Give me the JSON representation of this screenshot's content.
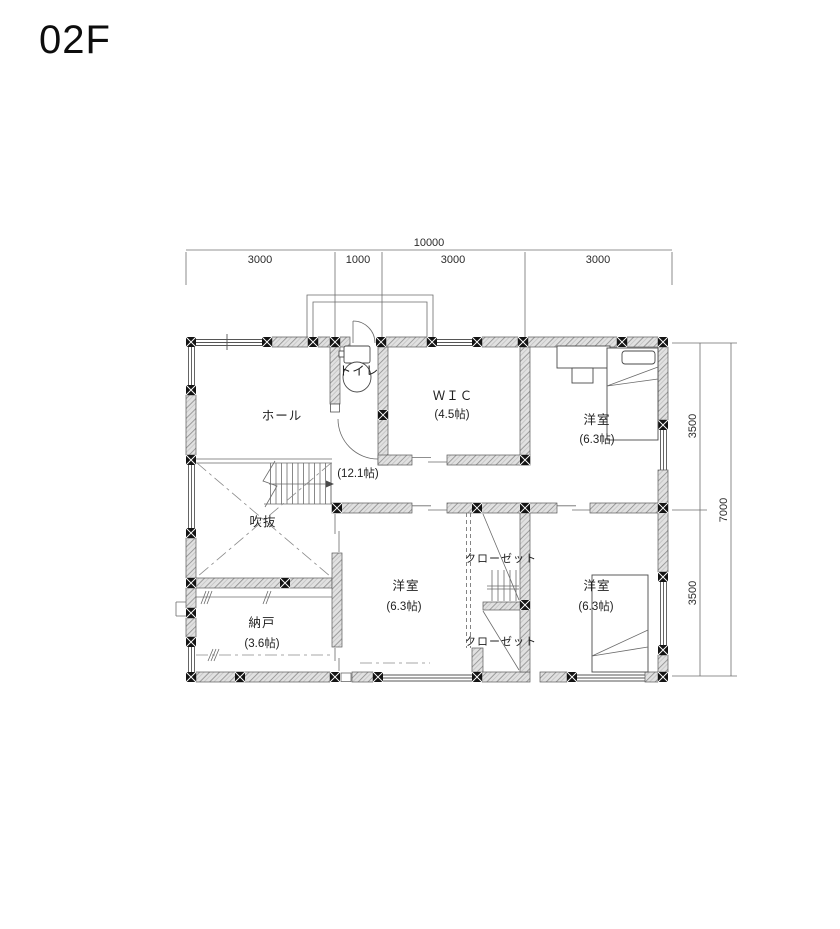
{
  "title": "02F",
  "plan": {
    "rooms": {
      "hall": {
        "name": "ホール",
        "size": "(12.1帖)"
      },
      "toilet": {
        "name": "トイレ"
      },
      "wic": {
        "name": "ＷＩＣ",
        "size": "(4.5帖)"
      },
      "bedroom_ne": {
        "name": "洋室",
        "size": "(6.3帖)"
      },
      "void_space": {
        "name": "吹抜"
      },
      "storage": {
        "name": "納戸",
        "size": "(3.6帖)"
      },
      "bedroom_s": {
        "name": "洋室",
        "size": "(6.3帖)"
      },
      "closet_upper": {
        "name": "クローゼット"
      },
      "closet_lower": {
        "name": "クローゼット"
      },
      "bedroom_se": {
        "name": "洋室",
        "size": "(6.3帖)"
      }
    },
    "dimensions": {
      "top": {
        "total": "10000",
        "segments": [
          "3000",
          "1000",
          "3000",
          "3000"
        ]
      },
      "right": {
        "total": "7000",
        "segments": [
          "3500",
          "3500"
        ]
      }
    }
  },
  "colors": {
    "wall_fill": "#e1e1e1",
    "wall_hatch": "#8f8f8f",
    "line": "#4a4a4a",
    "text": "#1f1f1f"
  }
}
